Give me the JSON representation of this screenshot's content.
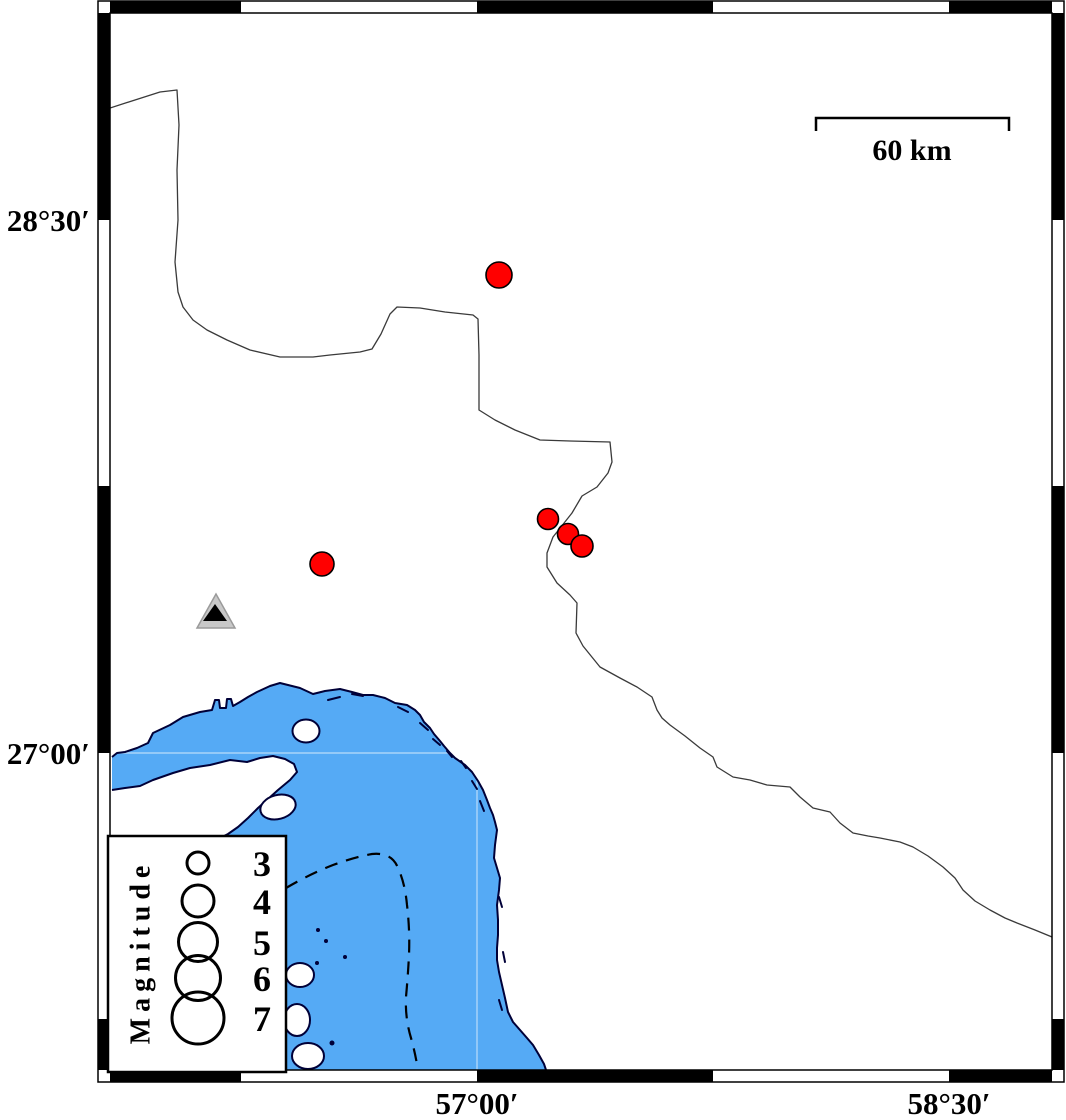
{
  "map": {
    "axis": {
      "left_labels": [
        {
          "text": "28°30′",
          "y": 220
        },
        {
          "text": "27°00′",
          "y": 753
        }
      ],
      "bottom_labels": [
        {
          "text": "57°00′",
          "x": 477
        },
        {
          "text": "58°30′",
          "x": 949
        }
      ]
    },
    "scale_bar": {
      "label": "60 km"
    },
    "legend": {
      "title": "Magnitude",
      "entries": [
        {
          "magnitude": "3",
          "diameter_px": 22,
          "y": 863
        },
        {
          "magnitude": "4",
          "diameter_px": 32,
          "y": 901
        },
        {
          "magnitude": "5",
          "diameter_px": 39,
          "y": 942
        },
        {
          "magnitude": "6",
          "diameter_px": 45,
          "y": 978
        },
        {
          "magnitude": "7",
          "diameter_px": 52,
          "y": 1018
        }
      ],
      "symbol_column_x": 198,
      "label_column_x": 262
    },
    "events": [
      {
        "x": 499,
        "y": 275,
        "diameter_px": 26
      },
      {
        "x": 548,
        "y": 519,
        "diameter_px": 21
      },
      {
        "x": 568,
        "y": 534,
        "diameter_px": 21
      },
      {
        "x": 582,
        "y": 546,
        "diameter_px": 22
      },
      {
        "x": 322,
        "y": 564,
        "diameter_px": 24
      }
    ],
    "station": {
      "x": 216,
      "y": 614
    },
    "colors": {
      "water": "#55AAF5",
      "coastline": "#000038",
      "earthquake": "#FF0000",
      "station_fill": "#C8C8C8",
      "frame": "#000000"
    }
  }
}
